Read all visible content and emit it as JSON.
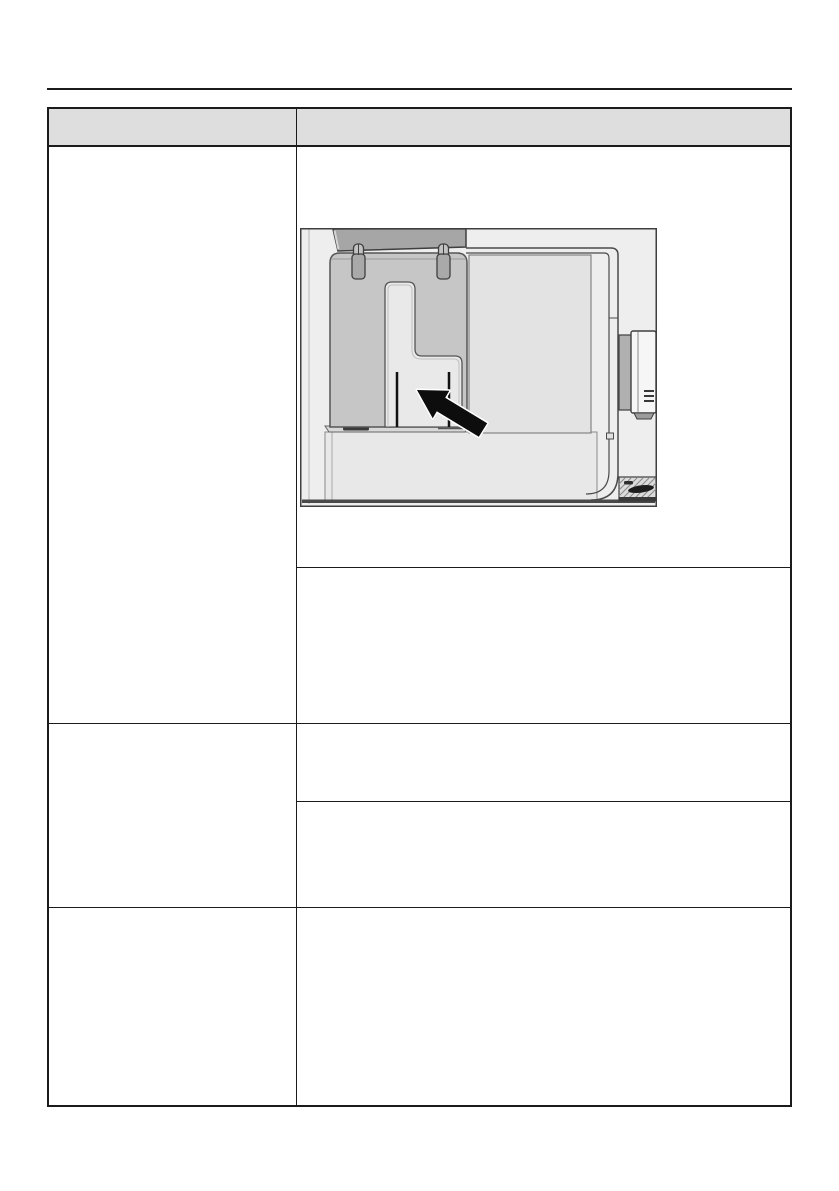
{
  "page": {
    "background_color": "#ffffff",
    "rule_color": "#1b1b1b"
  },
  "table": {
    "border_color": "#1b1b1b",
    "header_fill": "#dedede",
    "header": {
      "col1_label": "",
      "col2_label": ""
    },
    "rows": [
      {
        "left": "",
        "right_cells": [
          "",
          ""
        ]
      },
      {
        "left": "",
        "right_cells": [
          "",
          ""
        ]
      },
      {
        "left": "",
        "right_cells": [
          ""
        ]
      }
    ]
  },
  "figure": {
    "name": "appliance-interior-illustration",
    "colors": {
      "background": "#eeeeee",
      "outline": "#3f3f3f",
      "tank": "#c6c6c6",
      "cavity": "#e9e9e9",
      "lid": "#a6a6a6",
      "clip": "#a9a9a9",
      "side_panel": "#e3e3e3",
      "base": "#e8e8e8",
      "dispenser_body": "#f6f6f6",
      "dispenser_bracket": "#b0b0b0",
      "drip_tray": "#dcdcdc",
      "arrow_fill": "#0d0d0d",
      "arrow_outline": "#ffffff"
    }
  }
}
